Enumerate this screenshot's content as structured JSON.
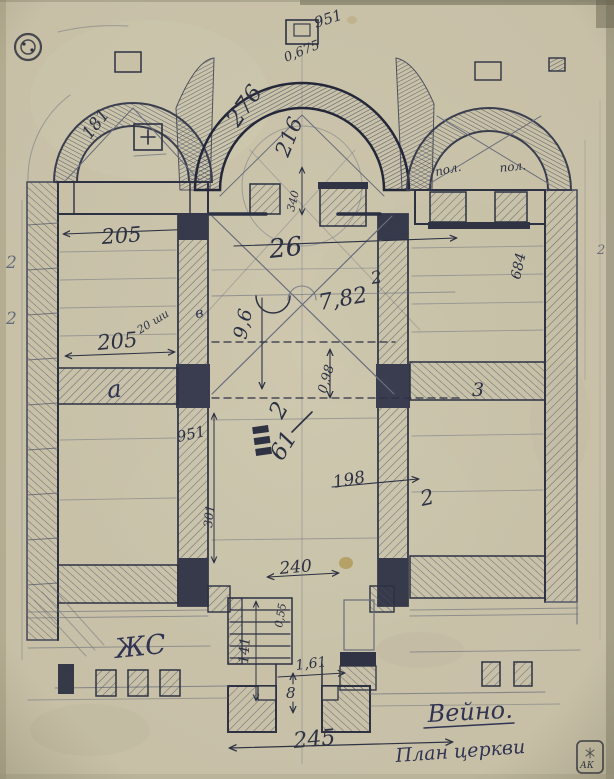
{
  "palette": {
    "paper": "#cfc8af",
    "ink": "#2c3144",
    "pencil": "#6b6f7e",
    "wall_hatch": "#4b5064",
    "stain": "#a9872f"
  },
  "drawing": {
    "title": "Вейно.",
    "subtitle": "План церкви",
    "monogram": "ЖС",
    "stamp": "АК",
    "annotations": [
      {
        "name": "dim-951-apex",
        "text": "951",
        "x": 316,
        "y": 28,
        "rot": -18,
        "size": 15,
        "cls": "ink"
      },
      {
        "name": "dim-0675-apex",
        "text": "0,675",
        "x": 286,
        "y": 62,
        "rot": -22,
        "size": 13,
        "cls": "ink"
      },
      {
        "name": "dim-276-central-apse",
        "text": "276",
        "x": 238,
        "y": 128,
        "rot": -55,
        "size": 23,
        "cls": "ink"
      },
      {
        "name": "dim-216-central-apse",
        "text": "216",
        "x": 288,
        "y": 158,
        "rot": -68,
        "size": 21,
        "cls": "ink"
      },
      {
        "name": "dim-181-left-apse",
        "text": "181",
        "x": 90,
        "y": 140,
        "rot": -52,
        "size": 17,
        "cls": "ink"
      },
      {
        "name": "dim-205-left-apse",
        "text": "205",
        "x": 102,
        "y": 244,
        "rot": -4,
        "size": 21,
        "cls": "ink"
      },
      {
        "name": "label-pol-left",
        "text": "пол.",
        "x": 436,
        "y": 176,
        "rot": -12,
        "size": 12,
        "cls": "ink"
      },
      {
        "name": "label-pol-right",
        "text": "пол.",
        "x": 500,
        "y": 172,
        "rot": -6,
        "size": 12,
        "cls": "ink"
      },
      {
        "name": "dim-26-crossing",
        "text": "26",
        "x": 270,
        "y": 258,
        "rot": -6,
        "size": 26,
        "cls": "ink"
      },
      {
        "name": "dim-782-crossing",
        "text": "7,82",
        "x": 320,
        "y": 310,
        "rot": -10,
        "size": 22,
        "cls": "ink"
      },
      {
        "name": "mark-2-right-of-crossing",
        "text": "2",
        "x": 372,
        "y": 284,
        "rot": -10,
        "size": 17,
        "cls": "ink"
      },
      {
        "name": "dim-96-vertical",
        "text": "9,6",
        "x": 246,
        "y": 340,
        "rot": -78,
        "size": 19,
        "cls": "ink"
      },
      {
        "name": "dim-098-vertical",
        "text": "0,98",
        "x": 326,
        "y": 394,
        "rot": -74,
        "size": 13,
        "cls": "ink"
      },
      {
        "name": "mark-2-below-crossing",
        "text": "2",
        "x": 282,
        "y": 420,
        "rot": -62,
        "size": 23,
        "cls": "ink"
      },
      {
        "name": "dim-340-opening",
        "text": "340",
        "x": 294,
        "y": 212,
        "rot": -76,
        "size": 11,
        "cls": "ink"
      },
      {
        "name": "note-20shi",
        "text": "20 ши",
        "x": 140,
        "y": 334,
        "rot": -32,
        "size": 11,
        "cls": "ink"
      },
      {
        "name": "mark-v-left-wall",
        "text": "в",
        "x": 196,
        "y": 318,
        "rot": -10,
        "size": 14,
        "cls": "script"
      },
      {
        "name": "label-a-left-wall",
        "text": "а",
        "x": 108,
        "y": 398,
        "rot": -6,
        "size": 24,
        "cls": "script"
      },
      {
        "name": "label-3-right-wall",
        "text": "3",
        "x": 472,
        "y": 396,
        "rot": 0,
        "size": 19,
        "cls": "ink"
      },
      {
        "name": "dim-951-left-wall",
        "text": "951",
        "x": 178,
        "y": 442,
        "rot": -12,
        "size": 15,
        "cls": "ink"
      },
      {
        "name": "dim-301-vertical",
        "text": "301",
        "x": 212,
        "y": 528,
        "rot": -84,
        "size": 12,
        "cls": "ink"
      },
      {
        "name": "dim-61-nave",
        "text": "61",
        "x": 282,
        "y": 462,
        "rot": -58,
        "size": 23,
        "cls": "ink"
      },
      {
        "name": "dim-198-nave",
        "text": "198",
        "x": 334,
        "y": 488,
        "rot": -10,
        "size": 17,
        "cls": "ink"
      },
      {
        "name": "mark-2-nave-right",
        "text": "2",
        "x": 422,
        "y": 506,
        "rot": -12,
        "size": 21,
        "cls": "ink"
      },
      {
        "name": "dim-684-right-edge",
        "text": "684",
        "x": 520,
        "y": 280,
        "rot": -78,
        "size": 14,
        "cls": "ink"
      },
      {
        "name": "dim-205-left-bay",
        "text": "205",
        "x": 98,
        "y": 350,
        "rot": -5,
        "size": 21,
        "cls": "ink"
      },
      {
        "name": "dim-240-porch",
        "text": "240",
        "x": 280,
        "y": 574,
        "rot": -5,
        "size": 17,
        "cls": "ink"
      },
      {
        "name": "dim-055-porch",
        "text": "0,55",
        "x": 282,
        "y": 628,
        "rot": -80,
        "size": 11,
        "cls": "ink"
      },
      {
        "name": "dim-141-porch",
        "text": "141",
        "x": 248,
        "y": 664,
        "rot": -86,
        "size": 14,
        "cls": "ink"
      },
      {
        "name": "dim-161-porch",
        "text": "1,61",
        "x": 296,
        "y": 670,
        "rot": -7,
        "size": 14,
        "cls": "ink"
      },
      {
        "name": "dim-8-entrance",
        "text": "8",
        "x": 286,
        "y": 698,
        "rot": 0,
        "size": 15,
        "cls": "ink"
      },
      {
        "name": "dim-245-porch",
        "text": "245",
        "x": 294,
        "y": 748,
        "rot": -5,
        "size": 22,
        "cls": "ink"
      },
      {
        "name": "mark-2-left-margin-upper",
        "text": "2",
        "x": 6,
        "y": 268,
        "rot": 0,
        "size": 17,
        "cls": "pencil"
      },
      {
        "name": "mark-2-left-margin-lower",
        "text": "2",
        "x": 6,
        "y": 324,
        "rot": 0,
        "size": 17,
        "cls": "pencil"
      },
      {
        "name": "mark-2-right-margin",
        "text": "2",
        "x": 597,
        "y": 254,
        "rot": 0,
        "size": 13,
        "cls": "pencil"
      },
      {
        "name": "monogram-zhs",
        "text": "ЖС",
        "x": 116,
        "y": 658,
        "rot": -6,
        "size": 27,
        "cls": "script"
      },
      {
        "name": "caption-veyno",
        "text": "Вейно.",
        "x": 428,
        "y": 722,
        "rot": -3,
        "size": 24,
        "cls": "script"
      },
      {
        "name": "caption-plan-tserkvi",
        "text": "План церкви",
        "x": 396,
        "y": 762,
        "rot": -4,
        "size": 19,
        "cls": "script"
      },
      {
        "name": "stamp-ak-letters",
        "text": "АК",
        "x": 580,
        "y": 768,
        "rot": 0,
        "size": 9,
        "cls": "ink"
      }
    ]
  }
}
